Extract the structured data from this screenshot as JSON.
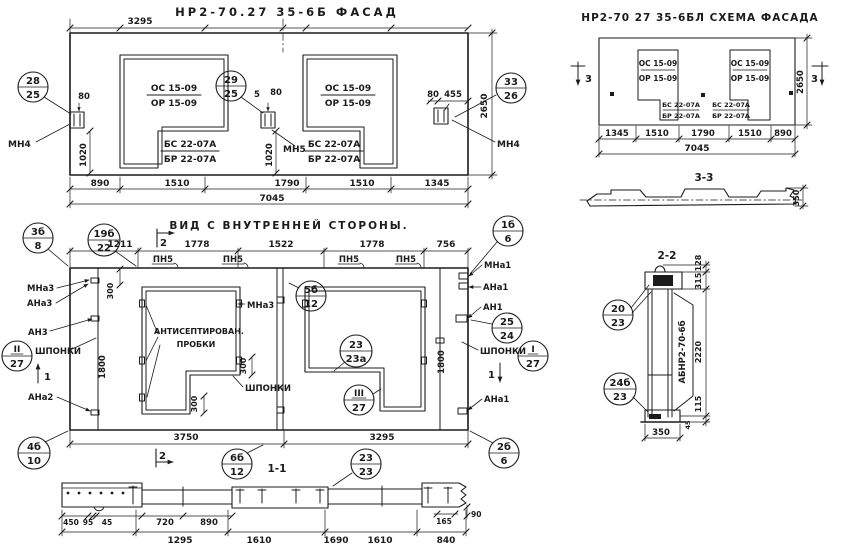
{
  "palette": {
    "paper": "#ffffff",
    "ink": "#1b1b1b"
  },
  "marks": {
    "window_top": "ОС 15-09",
    "window_bot": "ОР 15-09",
    "door_top": "БС 22-07А",
    "door_bot": "БР 22-07А",
    "loop": "ПН5"
  },
  "facade": {
    "title": "НР2-70.27 35-6б ФАСАД",
    "anchor_left": "МН4",
    "anchor_mid": "МН5",
    "anchor_right": "МН4",
    "balloons": [
      {
        "t": "28",
        "b": "25"
      },
      {
        "t": "29",
        "b": "25"
      },
      {
        "t": "33",
        "b": "26"
      }
    ],
    "dim_top": "3295",
    "d80l": "80",
    "d1020l": "1020",
    "d5": "5",
    "d80m": "80",
    "d1020m": "1020",
    "d80r": "80",
    "d455": "455",
    "height": "2650",
    "chain": [
      "890",
      "1510",
      "1790",
      "1510",
      "1345"
    ],
    "total": "7045"
  },
  "scheme": {
    "title": "НР2-70 27 35-6бл Схема фасада",
    "cut": "3",
    "height": "2650",
    "chain": [
      "1345",
      "1510",
      "1790",
      "1510",
      "890"
    ],
    "total": "7045"
  },
  "section33": {
    "label": "3-3",
    "thickness": "350"
  },
  "inner": {
    "title": "Вид с внутренней стороны.",
    "chain_top": [
      "1211",
      "1778",
      "1522",
      "1778",
      "756"
    ],
    "cut1": "1",
    "cut2": "2",
    "balloons": {
      "b3b8": {
        "t": "3б",
        "b": "8"
      },
      "b19b22": {
        "t": "19б",
        "b": "22"
      },
      "b1b6": {
        "t": "1б",
        "b": "6"
      },
      "b5b12": {
        "t": "5б",
        "b": "12"
      },
      "b23_23a": {
        "t": "23",
        "b": "23а"
      },
      "b25_24": {
        "t": "25",
        "b": "24"
      },
      "bI_27": {
        "t": "I",
        "b": "27"
      },
      "bII_27": {
        "t": "II",
        "b": "27"
      },
      "bIII_27": {
        "t": "III",
        "b": "27"
      },
      "b4b10": {
        "t": "4б",
        "b": "10"
      },
      "b6b12": {
        "t": "6б",
        "b": "12"
      },
      "b2b6": {
        "t": "2б",
        "b": "6"
      },
      "b23_23": {
        "t": "23",
        "b": "23"
      }
    },
    "lbl": {
      "mna3": "МНа3",
      "ana3": "АНа3",
      "an3": "АН3",
      "shponki": "шпонки",
      "ana2": "АНа2",
      "mna1": "МНа1",
      "ana1": "АНа1",
      "an1": "АН1",
      "probki1": "Антисептирован.",
      "probki2": "пробки"
    },
    "d300": "300",
    "d1800": "1800",
    "chain_bottom": [
      "3750",
      "3295"
    ]
  },
  "section11": {
    "label": "1-1",
    "dims_detail": [
      "450",
      "95",
      "45",
      "720",
      "890",
      "165",
      "90"
    ],
    "chain": [
      "1295",
      "1610",
      "1690",
      "1610",
      "840"
    ]
  },
  "section22": {
    "label": "2-2",
    "mark": "АБНР2-70-6б",
    "balloons": [
      {
        "t": "20",
        "b": "23"
      },
      {
        "t": "24б",
        "b": "23"
      }
    ],
    "dims": [
      "128",
      "315",
      "2220",
      "115",
      "45"
    ],
    "width": "350"
  }
}
